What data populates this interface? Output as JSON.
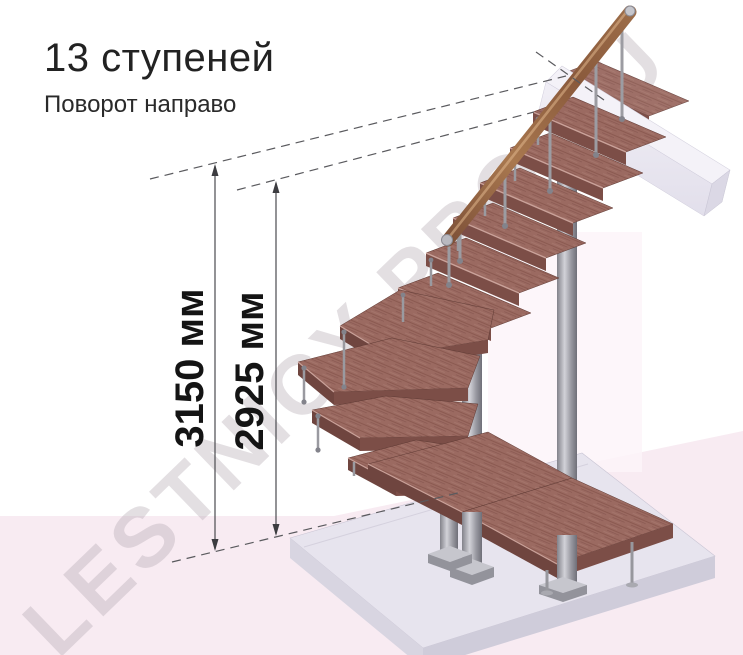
{
  "title": "13 ступеней",
  "subtitle": "Поворот направо",
  "steps_count": "13",
  "turn_direction": "направо",
  "dimensions": {
    "total": "3150 мм",
    "upper": "2925 мм"
  },
  "watermark": "LESTNICY-PRO.RU",
  "colors": {
    "tread_wood": "#9b6a61",
    "tread_front": "#7c4e47",
    "handrail_wood": "#a5744e",
    "metal": "#a8a8ae",
    "floor_pink": "#f8ebf2",
    "slab_gray": "#e7e4ee",
    "dimension_line": "#4b4b4f",
    "text": "#1f1f1f"
  }
}
